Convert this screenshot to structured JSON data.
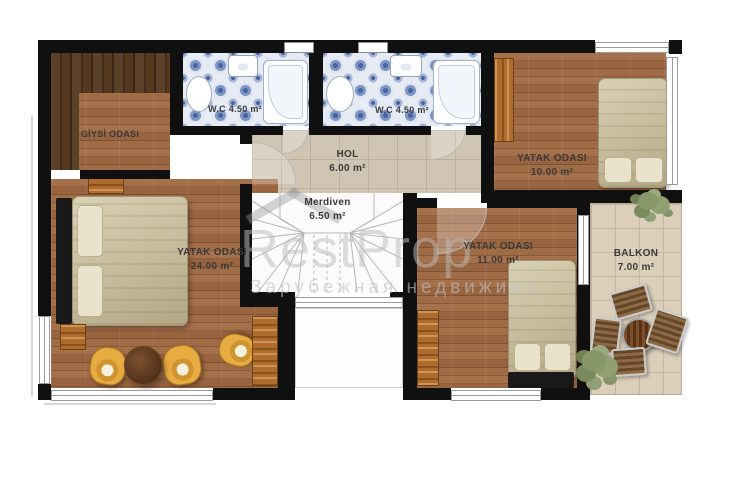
{
  "watermark": {
    "brand": "RestProp",
    "subtitle": "Зарубежная недвижимо"
  },
  "rooms": [
    {
      "id": "giysi-odasi",
      "name": "GİYSİ ODASI",
      "area": ""
    },
    {
      "id": "wc-1",
      "name": "W.C",
      "area": "4.50 m²"
    },
    {
      "id": "wc-2",
      "name": "W.C",
      "area": "4.50 m²"
    },
    {
      "id": "hol",
      "name": "HOL",
      "area": "6.00 m²"
    },
    {
      "id": "merdiven",
      "name": "Merdiven",
      "area": "6.50 m²"
    },
    {
      "id": "yatak-odasi-24",
      "name": "YATAK ODASI",
      "area": "24.00 m²"
    },
    {
      "id": "yatak-odasi-10",
      "name": "YATAK ODASI",
      "area": "10.00 m²"
    },
    {
      "id": "yatak-odasi-11",
      "name": "YATAK ODASI",
      "area": "11.00 m²"
    },
    {
      "id": "balkon",
      "name": "BALKON",
      "area": "7.00 m²"
    }
  ],
  "colors": {
    "wall": "#111111",
    "wood_floor": "#9c6a46",
    "wood_dark": "#4f3724",
    "tile_blue": "#5b79b4",
    "tile_beige": "#cfc5b2",
    "balcony_tile": "#dbcfba",
    "furniture_accent": "#e2a83e",
    "bedding": "#cbc3a4",
    "plant": "#87976a"
  }
}
